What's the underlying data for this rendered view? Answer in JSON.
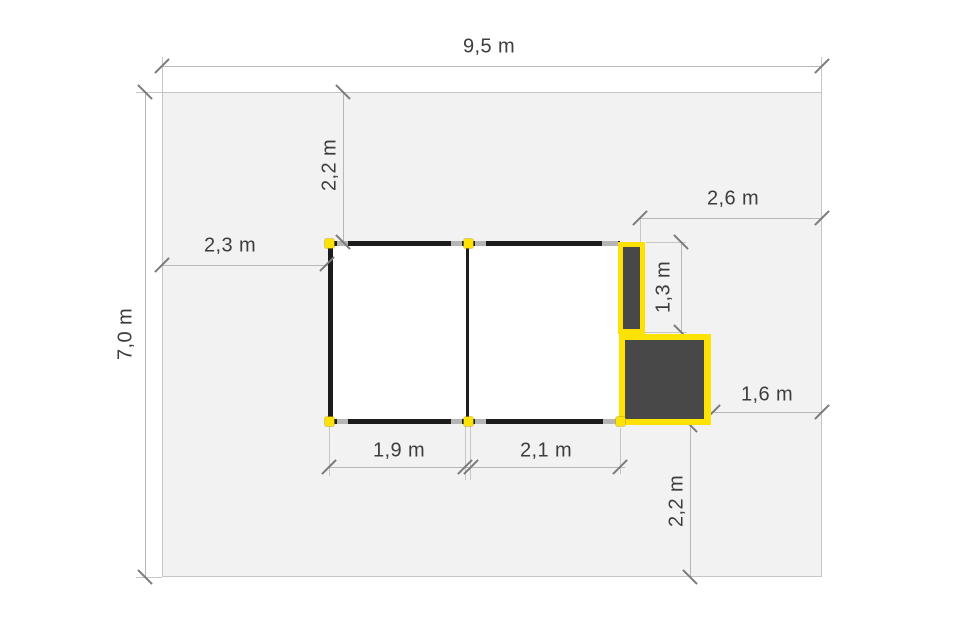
{
  "diagram": {
    "type": "site-plan-with-dimensions",
    "units": "m"
  },
  "labels": {
    "plot_width": "9,5 m",
    "plot_depth": "7,0 m",
    "top_setback": "2,2 m",
    "left_setback": "2,3 m",
    "top_right_clearance": "2,6 m",
    "annex_height": "1,3 m",
    "right_clearance": "1,6 m",
    "left_module_width": "1,9 m",
    "right_module_width": "2,1 m",
    "bottom_clearance": "2,2 m"
  },
  "colors": {
    "plot_fill": "#f2f2f2",
    "wall": "#1c1c1c",
    "highlight_yellow": "#ffe205",
    "dark_fill": "#484848",
    "dimension_line": "#b8b8b8",
    "text": "#3d3d3d"
  }
}
